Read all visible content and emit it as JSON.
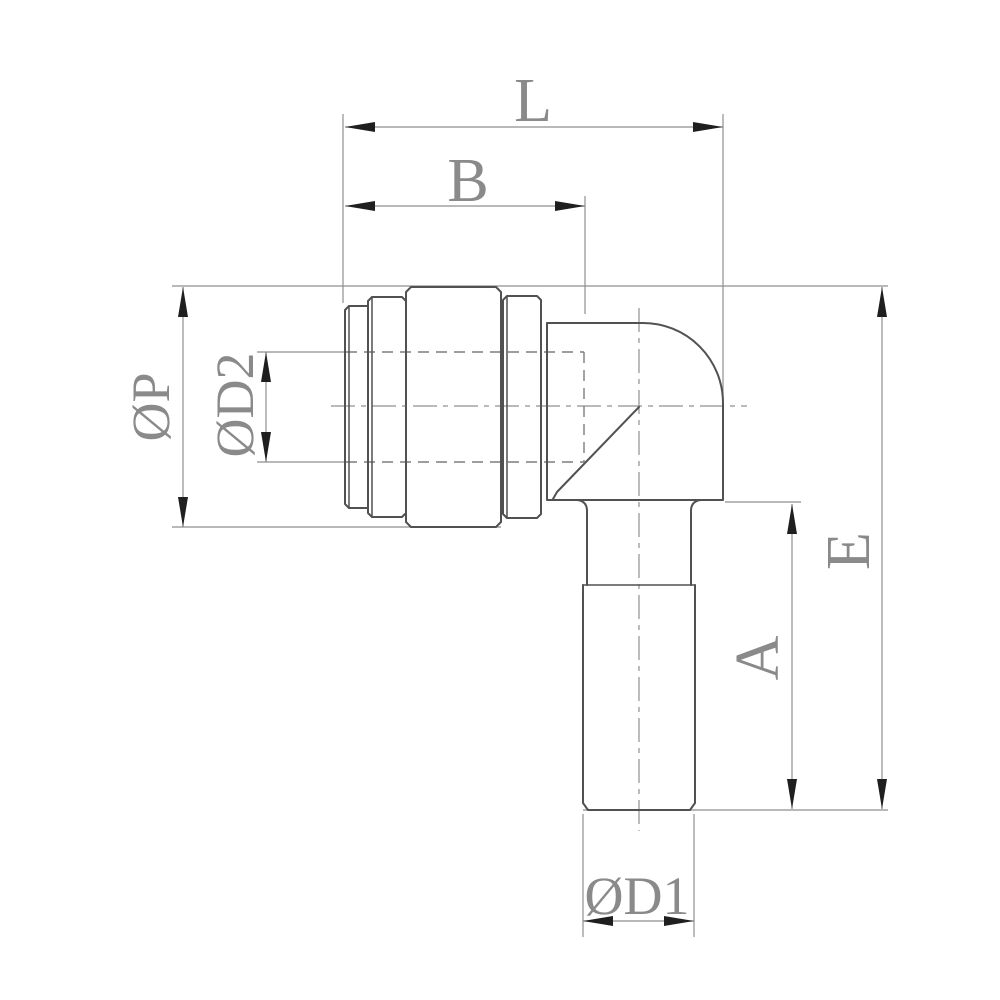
{
  "drawing": {
    "description": "2D engineering line drawing, side view of a 90-degree push-in elbow pneumatic fitting with dimension callouts",
    "labels": {
      "L": "L",
      "B": "B",
      "P": "ØP",
      "D2": "ØD2",
      "E": "E",
      "A": "A",
      "D1": "ØD1"
    },
    "colors": {
      "background": "#ffffff",
      "outline": "#515151",
      "dimension_line": "#8f8f8f",
      "hidden_line": "#7d7d7d",
      "centerline": "#909090",
      "arrowhead": "#1f1f1f",
      "label_text": "#8a8a8a"
    }
  }
}
